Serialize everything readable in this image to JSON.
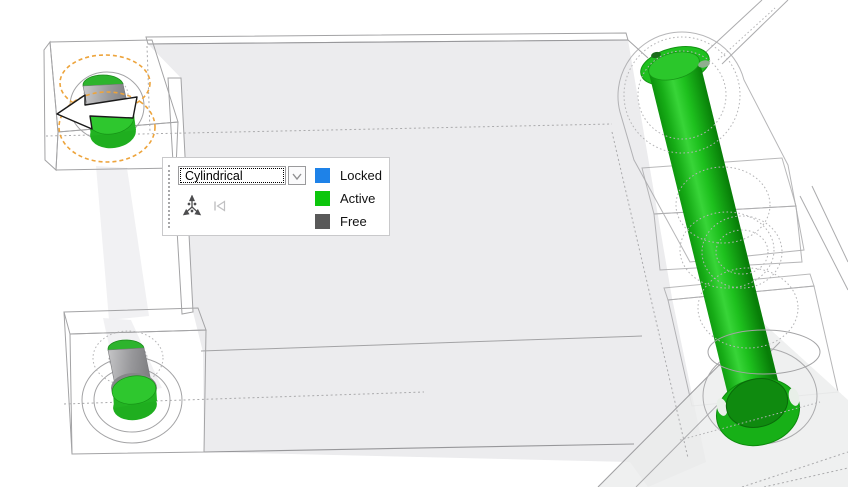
{
  "minitoolbar": {
    "joint_type": {
      "value": "Cylindrical"
    },
    "legend": [
      {
        "label": "Locked",
        "color": "#1e82e8"
      },
      {
        "label": "Active",
        "color": "#0cc60c"
      },
      {
        "label": "Free",
        "color": "#595959"
      }
    ]
  },
  "scene": {
    "active_part_color": "#1fc01f",
    "manipulator_color": "#eda43c"
  }
}
